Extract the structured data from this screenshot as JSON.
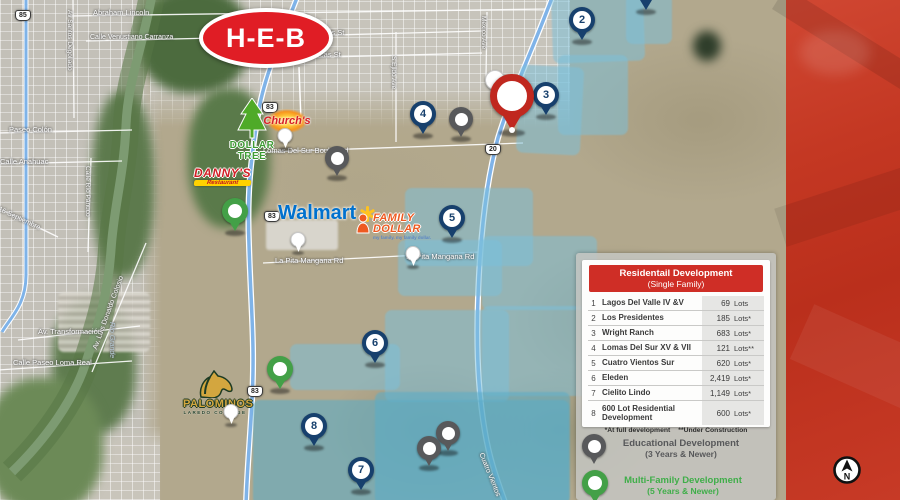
{
  "brands": {
    "heb": "H-E-B",
    "dollar_tree": "DOLLAR TREE",
    "churchs": "Church's",
    "dannys": "DANNY'S",
    "dannys_sub": "Restaurant",
    "walmart": "Walmart",
    "family_dollar_line1": "FAMILY",
    "family_dollar_line2": "DOLLAR",
    "family_dollar_tagline": "my family. my family dollar.",
    "palominos": "PALOMINOS",
    "palominos_sub": "LAREDO COLLEGE"
  },
  "shields": {
    "s83": "83",
    "s85": "85",
    "s20": "20"
  },
  "streets": {
    "abraham_lincoln": "Abraham Lincoln",
    "carranza": "Calle Venustiano Carranza",
    "santos_degollado": "Av Santos Degollado",
    "san_luis": "San Luis St",
    "zacatecas": "Zacatecas St",
    "paseo_colon": "Paseo Colón",
    "anahuac": "Calle Anahuac",
    "rio_panuco": "Calle Río Pánuco",
    "septiembre": "16 Septiembre",
    "transformacion": "Av. Transformación",
    "colosio": "Av. Luis Donaldo Colosio",
    "rio_grande": "Río Grande",
    "loma_real": "Calle Paseo Loma Real",
    "lomas_del_sur": "Lomas Del Sur Boulevard",
    "la_pita_1": "La Pita Mangana Rd",
    "la_pita_2": "La Pita Mangana Rd",
    "mexico_ave": "Mexico Ave",
    "ejido_ave": "S Ejido Ave",
    "cuatro_vientos": "Cuatro Vientos"
  },
  "markers": {
    "m2": "2",
    "m3": "3",
    "m4": "4",
    "m5": "5",
    "m6": "6",
    "m7": "7",
    "m8": "8"
  },
  "table": {
    "title_line1": "Residentail Development",
    "title_line2": "(Single Family)",
    "rows": [
      {
        "num": "1",
        "name": "Lagos Del Valle IV &V",
        "value": "69",
        "unit": "Lots"
      },
      {
        "num": "2",
        "name": "Los Presidentes",
        "value": "185",
        "unit": "Lots*"
      },
      {
        "num": "3",
        "name": "Wright Ranch",
        "value": "683",
        "unit": "Lots*"
      },
      {
        "num": "4",
        "name": "Lomas Del Sur XV & VII",
        "value": "121",
        "unit": "Lots**"
      },
      {
        "num": "5",
        "name": "Cuatro Vientos Sur",
        "value": "620",
        "unit": "Lots*"
      },
      {
        "num": "6",
        "name": "Eleden",
        "value": "2,419",
        "unit": "Lots*"
      },
      {
        "num": "7",
        "name": "Cielito Lindo",
        "value": "1,149",
        "unit": "Lots*"
      },
      {
        "num": "8",
        "name": "600 Lot Residential Development",
        "value": "600",
        "unit": "Lots*"
      }
    ],
    "footnote1": "*At full development",
    "footnote2": "**Under Construction"
  },
  "legend": {
    "educational": {
      "line1": "Educational Development",
      "line2": "(3 Years & Newer)"
    },
    "multifamily": {
      "line1": "Multi-Family Development",
      "line2": "(5 Years & Newer)"
    }
  },
  "compass": {
    "north": "N"
  },
  "colors": {
    "marker_navy": "#17406d",
    "pin_red": "#c0281f",
    "pin_gray": "#58595b",
    "pin_green": "#43a047",
    "table_header_red": "#cf2e26",
    "dev_zone_blue": "#7ac0da",
    "sidebar_red": "#c43823",
    "legend_green_text": "#3fae49"
  }
}
